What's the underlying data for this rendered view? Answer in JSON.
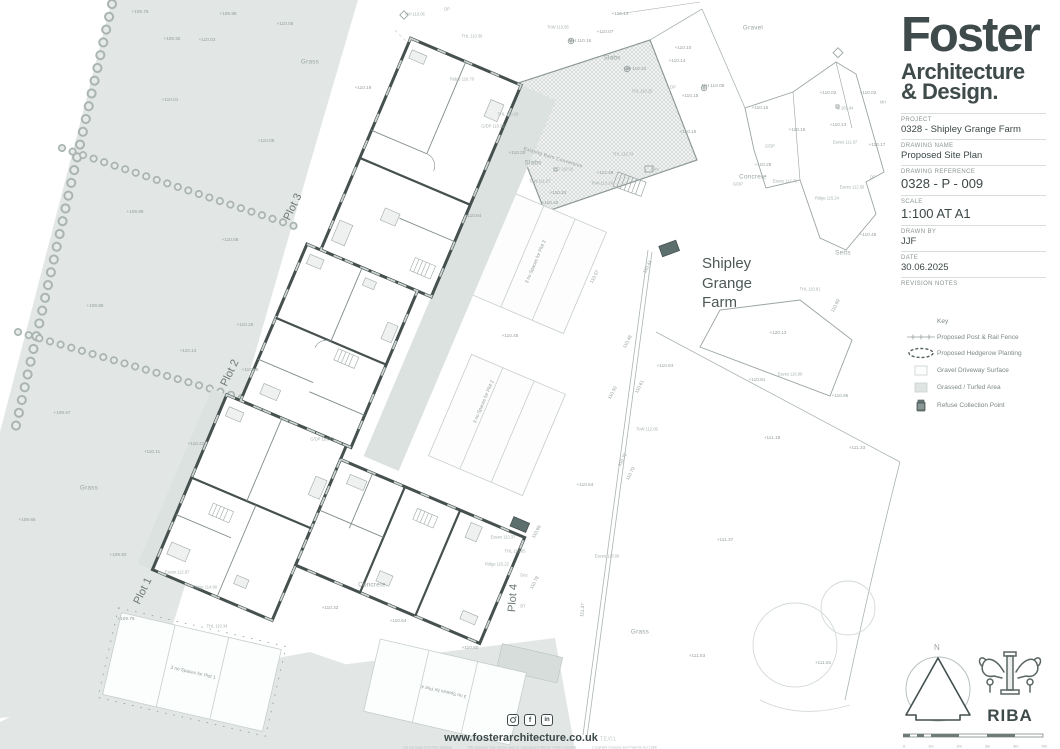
{
  "colors": {
    "accent_dark": "#3f4b4b",
    "wall": "#45504f",
    "grass": "#e2e7e5",
    "patio": "#dbe2e0",
    "refuse": "#5d6f6d",
    "line": "#9aa4a2"
  },
  "title_block": {
    "logo": {
      "line1": "Foster",
      "line2": "Architecture",
      "line3": "& Design."
    },
    "fields": [
      {
        "label": "PROJECT",
        "value": "0328 - Shipley Grange Farm",
        "big": false
      },
      {
        "label": "DRAWING NAME",
        "value": "Proposed Site Plan",
        "big": false
      },
      {
        "label": "DRAWING REFERENCE",
        "value": "0328 - P - 009",
        "big": true
      },
      {
        "label": "SCALE",
        "value": "1:100 AT A1",
        "big": true
      },
      {
        "label": "DRAWN BY",
        "value": "JJF",
        "big": false
      },
      {
        "label": "DATE",
        "value": "30.06.2025",
        "big": false
      },
      {
        "label": "REVISION NOTES",
        "value": "",
        "big": false
      }
    ]
  },
  "key": {
    "title": "Key",
    "items": [
      {
        "icon": "fence-symbol",
        "label": "Proposed Post & Rail Fence"
      },
      {
        "icon": "hedgerow-symbol",
        "label": "Proposed Hedgerow Planting"
      },
      {
        "icon": "gravel-swatch",
        "label": "Gravel Driveway Surface"
      },
      {
        "icon": "grass-swatch",
        "label": "Grassed / Turfed Area"
      },
      {
        "icon": "refuse-bin-icon",
        "label": "Refuse Collection Point"
      }
    ]
  },
  "compass": {
    "n_label": "N"
  },
  "riba": {
    "label": "RIBA"
  },
  "scale_bar": {
    "labels": [
      "0",
      "1m",
      "2m",
      "3m",
      "4m",
      "5m"
    ]
  },
  "footer": {
    "website": "www.fosterarchitecture.co.uk",
    "revision": "TE/01",
    "disclaimers": [
      "Do not scale from this drawing",
      "This drawing may not be used or reproduced without written consent",
      "Copyright Designs and Patents Act 1988"
    ]
  },
  "plan": {
    "site_label": {
      "x": 727,
      "y": 283,
      "t": "Shipley\nGrange\nFarm"
    },
    "labels": [
      {
        "x": 140,
        "y": 12,
        "t": "+109.76"
      },
      {
        "x": 228,
        "y": 14,
        "t": "+109.98"
      },
      {
        "x": 285,
        "y": 24,
        "t": "+110.05"
      },
      {
        "x": 172,
        "y": 39,
        "t": "+109.92"
      },
      {
        "x": 207,
        "y": 40,
        "t": "+110.03"
      },
      {
        "x": 310,
        "y": 62,
        "t": "Grass",
        "c": "area"
      },
      {
        "x": 170,
        "y": 100,
        "t": "+110.01"
      },
      {
        "x": 266,
        "y": 141,
        "t": "+110.08"
      },
      {
        "x": 135,
        "y": 212,
        "t": "+109.89"
      },
      {
        "x": 230,
        "y": 240,
        "t": "+110.08"
      },
      {
        "x": 95,
        "y": 306,
        "t": "+109.85"
      },
      {
        "x": 188,
        "y": 351,
        "t": "+110.13"
      },
      {
        "x": 62,
        "y": 413,
        "t": "+109.67"
      },
      {
        "x": 152,
        "y": 452,
        "t": "+110.11"
      },
      {
        "x": 196,
        "y": 444,
        "t": "+110.42"
      },
      {
        "x": 27,
        "y": 520,
        "t": "+109.66"
      },
      {
        "x": 118,
        "y": 555,
        "t": "+109.93"
      },
      {
        "x": 89,
        "y": 488,
        "t": "Grass",
        "c": "area"
      },
      {
        "x": 126,
        "y": 619,
        "t": "+109.78"
      },
      {
        "x": 415,
        "y": 15,
        "t": "MH 110.06",
        "c": "ann"
      },
      {
        "x": 447,
        "y": 10,
        "t": "DP",
        "c": "ann"
      },
      {
        "x": 363,
        "y": 88,
        "t": "+110.19"
      },
      {
        "x": 472,
        "y": 37,
        "t": "THL 110.36",
        "c": "ann"
      },
      {
        "x": 462,
        "y": 80,
        "t": "Ridge 116.70",
        "c": "ann"
      },
      {
        "x": 620,
        "y": 14,
        "t": "+110.13"
      },
      {
        "x": 558,
        "y": 28,
        "t": "ToW 110.85",
        "c": "ann"
      },
      {
        "x": 605,
        "y": 32,
        "t": "+110.07"
      },
      {
        "x": 580,
        "y": 41,
        "t": "MH 110.16"
      },
      {
        "x": 635,
        "y": 69,
        "t": "MH 110.22"
      },
      {
        "x": 683,
        "y": 48,
        "t": "+110.10"
      },
      {
        "x": 677,
        "y": 61,
        "t": "+110.14"
      },
      {
        "x": 642,
        "y": 92,
        "t": "THL 110.29",
        "c": "ann"
      },
      {
        "x": 673,
        "y": 88,
        "t": "DP",
        "c": "ann"
      },
      {
        "x": 690,
        "y": 96,
        "t": "+110.15"
      },
      {
        "x": 688,
        "y": 132,
        "t": "+110.16"
      },
      {
        "x": 508,
        "y": 115,
        "t": "THL 110.28",
        "c": "ann"
      },
      {
        "x": 493,
        "y": 127,
        "t": "G/DP 110.22",
        "c": "ann"
      },
      {
        "x": 517,
        "y": 153,
        "t": "+110.20"
      },
      {
        "x": 612,
        "y": 58,
        "t": "Slabs",
        "c": "area"
      },
      {
        "x": 533,
        "y": 163,
        "t": "Slabs",
        "c": "area"
      },
      {
        "x": 565,
        "y": 170,
        "t": "G 110.16",
        "c": "ann"
      },
      {
        "x": 540,
        "y": 182,
        "t": "ToW 111.07",
        "c": "ann"
      },
      {
        "x": 558,
        "y": 193,
        "t": "+110.22"
      },
      {
        "x": 605,
        "y": 173,
        "t": "+112.49"
      },
      {
        "x": 602,
        "y": 184,
        "t": "ToW 113.24",
        "c": "ann"
      },
      {
        "x": 655,
        "y": 170,
        "t": "Elec",
        "c": "ann"
      },
      {
        "x": 623,
        "y": 155,
        "t": "THL 112.74",
        "c": "ann"
      },
      {
        "x": 553,
        "y": 158,
        "t": "Existing Barn Conversion",
        "c": "barn",
        "r": 17
      },
      {
        "x": 753,
        "y": 28,
        "t": "Gravel",
        "c": "area"
      },
      {
        "x": 713,
        "y": 86,
        "t": "MH 110.08"
      },
      {
        "x": 828,
        "y": 93,
        "t": "+110.02"
      },
      {
        "x": 868,
        "y": 93,
        "t": "+110.02"
      },
      {
        "x": 760,
        "y": 108,
        "t": "+110.16"
      },
      {
        "x": 845,
        "y": 109,
        "t": "G 109.94",
        "c": "ann"
      },
      {
        "x": 883,
        "y": 103,
        "t": "MH",
        "c": "ann"
      },
      {
        "x": 838,
        "y": 125,
        "t": "+110.13"
      },
      {
        "x": 877,
        "y": 145,
        "t": "+110.17"
      },
      {
        "x": 797,
        "y": 130,
        "t": "+110.16"
      },
      {
        "x": 770,
        "y": 147,
        "t": "G/DP",
        "c": "ann"
      },
      {
        "x": 763,
        "y": 165,
        "t": "+110.28"
      },
      {
        "x": 738,
        "y": 185,
        "t": "G/DP",
        "c": "ann"
      },
      {
        "x": 753,
        "y": 177,
        "t": "Concrete",
        "c": "area"
      },
      {
        "x": 785,
        "y": 182,
        "t": "Eaves 112.76",
        "c": "ann"
      },
      {
        "x": 845,
        "y": 143,
        "t": "Eaves 111.97",
        "c": "ann"
      },
      {
        "x": 852,
        "y": 188,
        "t": "Eaves 112.56",
        "c": "ann"
      },
      {
        "x": 827,
        "y": 199,
        "t": "Ridge 115.24",
        "c": "ann"
      },
      {
        "x": 873,
        "y": 178,
        "t": "DP",
        "c": "ann"
      },
      {
        "x": 868,
        "y": 235,
        "t": "+110.46"
      },
      {
        "x": 843,
        "y": 253,
        "t": "Setts",
        "c": "area"
      },
      {
        "x": 810,
        "y": 290,
        "t": "THL 110.81",
        "c": "ann"
      },
      {
        "x": 836,
        "y": 306,
        "t": "110.89",
        "r": -62
      },
      {
        "x": 778,
        "y": 333,
        "t": "+120.12"
      },
      {
        "x": 790,
        "y": 375,
        "t": "Eaves 116.90",
        "c": "ann"
      },
      {
        "x": 757,
        "y": 380,
        "t": "+110.81"
      },
      {
        "x": 840,
        "y": 396,
        "t": "+110.95"
      },
      {
        "x": 772,
        "y": 438,
        "t": "+111.18"
      },
      {
        "x": 857,
        "y": 448,
        "t": "+111.33"
      },
      {
        "x": 595,
        "y": 277,
        "t": "110.57",
        "r": -62
      },
      {
        "x": 648,
        "y": 267,
        "t": "110.41",
        "r": -62
      },
      {
        "x": 628,
        "y": 342,
        "t": "110.48",
        "r": -62
      },
      {
        "x": 665,
        "y": 366,
        "t": "+110.63"
      },
      {
        "x": 640,
        "y": 387,
        "t": "110.61",
        "r": -62
      },
      {
        "x": 613,
        "y": 393,
        "t": "110.50",
        "r": -62
      },
      {
        "x": 647,
        "y": 430,
        "t": "ToW 112.06",
        "c": "ann"
      },
      {
        "x": 623,
        "y": 460,
        "t": "110.72",
        "r": -62
      },
      {
        "x": 631,
        "y": 474,
        "t": "110.79",
        "r": -62
      },
      {
        "x": 473,
        "y": 216,
        "t": "+110.64"
      },
      {
        "x": 550,
        "y": 203,
        "t": "+110.40"
      },
      {
        "x": 510,
        "y": 336,
        "t": "+110.45"
      },
      {
        "x": 536,
        "y": 262,
        "t": "3 no Spaces for Plot 3",
        "c": "park",
        "r": -67
      },
      {
        "x": 484,
        "y": 402,
        "t": "3 no Spaces for Plot 2",
        "c": "park",
        "r": -67
      },
      {
        "x": 250,
        "y": 370,
        "t": "+110.55"
      },
      {
        "x": 322,
        "y": 440,
        "t": "G/DP 110.57",
        "c": "ann"
      },
      {
        "x": 245,
        "y": 325,
        "t": "+110.25"
      },
      {
        "x": 293,
        "y": 207,
        "t": "Plot 3",
        "c": "plot",
        "r": -64
      },
      {
        "x": 230,
        "y": 373,
        "t": "Plot 2",
        "c": "plot",
        "r": -64
      },
      {
        "x": 143,
        "y": 591,
        "t": "Plot 1",
        "c": "plot",
        "r": -64
      },
      {
        "x": 513,
        "y": 598,
        "t": "Plot 4",
        "c": "plot",
        "r": -86
      },
      {
        "x": 585,
        "y": 485,
        "t": "+110.64"
      },
      {
        "x": 607,
        "y": 557,
        "t": "Eaves 113.00",
        "c": "ann"
      },
      {
        "x": 583,
        "y": 610,
        "t": "111.37",
        "r": -85
      },
      {
        "x": 535,
        "y": 583,
        "t": "110.78",
        "r": -62
      },
      {
        "x": 537,
        "y": 532,
        "t": "110.66",
        "r": -62
      },
      {
        "x": 524,
        "y": 576,
        "t": "Dec",
        "c": "ann"
      },
      {
        "x": 515,
        "y": 552,
        "t": "THL 110.85",
        "c": "ann"
      },
      {
        "x": 497,
        "y": 565,
        "t": "Ridge 115.22",
        "c": "ann"
      },
      {
        "x": 503,
        "y": 538,
        "t": "Eaves 113.37",
        "c": "ann"
      },
      {
        "x": 523,
        "y": 607,
        "t": "BT",
        "c": "ann"
      },
      {
        "x": 177,
        "y": 573,
        "t": "Eaves 112.97",
        "c": "ann"
      },
      {
        "x": 205,
        "y": 588,
        "t": "Ridge 114.90",
        "c": "ann"
      },
      {
        "x": 217,
        "y": 627,
        "t": "THL 110.34",
        "c": "ann"
      },
      {
        "x": 330,
        "y": 608,
        "t": "+110.32"
      },
      {
        "x": 398,
        "y": 621,
        "t": "+110.64"
      },
      {
        "x": 470,
        "y": 648,
        "t": "+110.80"
      },
      {
        "x": 372,
        "y": 585,
        "t": "Concrete",
        "c": "area"
      },
      {
        "x": 640,
        "y": 632,
        "t": "Grass",
        "c": "area"
      },
      {
        "x": 697,
        "y": 656,
        "t": "+111.53"
      },
      {
        "x": 823,
        "y": 663,
        "t": "+111.81"
      },
      {
        "x": 725,
        "y": 540,
        "t": "+111.37"
      },
      {
        "x": 193,
        "y": 673,
        "t": "3 no Spaces for Plot 1",
        "c": "park",
        "r": 13
      },
      {
        "x": 444,
        "y": 691,
        "t": "3 no Spaces for Plot 4",
        "c": "park",
        "r": 193
      }
    ]
  }
}
